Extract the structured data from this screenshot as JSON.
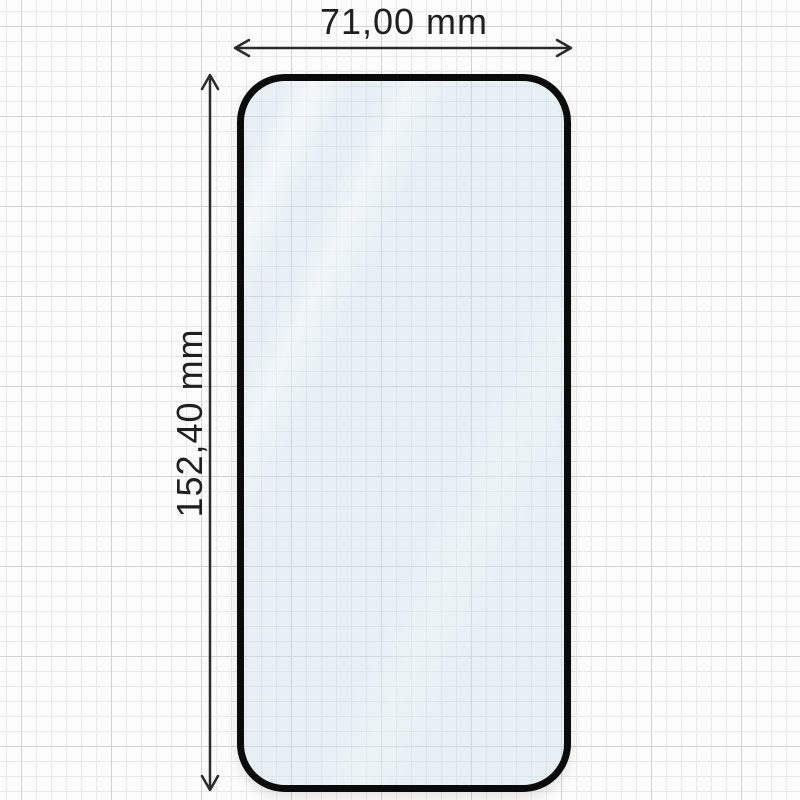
{
  "diagram": {
    "width_label": "71,00 mm",
    "height_label": "152,40 mm"
  },
  "colors": {
    "dimension_lines": "#2b2b2b",
    "label_color": "#1f1f1f",
    "glass_border": "#0b0b0b",
    "glass_tint": "#cbe0ed",
    "grid_minor": "#e9e9e9",
    "grid_major": "#d3d3d3",
    "paper": "#fcfcfc"
  }
}
